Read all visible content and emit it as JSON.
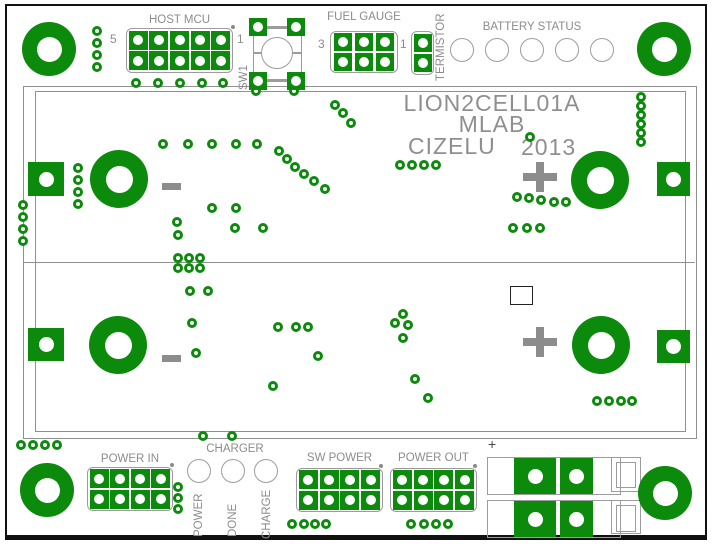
{
  "title_block": {
    "product": "LION2CELL01A",
    "org": "MLAB",
    "author": "CIZELU",
    "year": "2013"
  },
  "connectors": {
    "host_mcu": {
      "label": "HOST MCU",
      "pin_left": "5",
      "pin_right": "1"
    },
    "sw1": {
      "label": "SW1"
    },
    "fuel_gauge": {
      "label": "FUEL GAUGE",
      "pin_left": "3",
      "pin_right": "1"
    },
    "termistor": {
      "label": "TERMISTOR"
    },
    "battery_status": {
      "label": "BATTERY STATUS",
      "led_count": 5
    },
    "power_in": {
      "label": "POWER IN"
    },
    "charger": {
      "label": "CHARGER",
      "leds": [
        "POWER",
        "DONE",
        "CHARGE"
      ]
    },
    "sw_power": {
      "label": "SW POWER"
    },
    "power_out": {
      "label": "POWER OUT"
    },
    "battery_connector": {
      "polarity_label": "+"
    }
  },
  "colors": {
    "copper_green": "#0b8a0b",
    "silkscreen_gray": "#8c8c8c",
    "outline_gray": "#9c9c9c",
    "board_frame": "#111111",
    "background": "#ffffff"
  },
  "polarity_marks": {
    "plus_centers": [
      [
        540,
        177
      ],
      [
        540,
        342
      ]
    ],
    "minus_centers": [
      [
        171,
        186
      ],
      [
        171,
        358
      ]
    ]
  },
  "drill": {
    "mounting_holes": [
      [
        49,
        49
      ],
      [
        664,
        49
      ],
      [
        47,
        490
      ],
      [
        665,
        493
      ]
    ],
    "battery_rings": [
      [
        119,
        179
      ],
      [
        600,
        180
      ],
      [
        118,
        345
      ],
      [
        601,
        345
      ]
    ],
    "square_pads": [
      {
        "x": 28,
        "y": 162,
        "w": 36,
        "h": 34
      },
      {
        "x": 657,
        "y": 162,
        "w": 33,
        "h": 34
      },
      {
        "x": 28,
        "y": 328,
        "w": 36,
        "h": 33
      },
      {
        "x": 657,
        "y": 330,
        "w": 33,
        "h": 33
      },
      {
        "x": 514,
        "y": 458,
        "w": 42,
        "h": 36
      },
      {
        "x": 560,
        "y": 458,
        "w": 33,
        "h": 36
      },
      {
        "x": 514,
        "y": 501,
        "w": 42,
        "h": 36
      },
      {
        "x": 560,
        "y": 501,
        "w": 33,
        "h": 36
      }
    ],
    "vias": [
      [
        97,
        31
      ],
      [
        97,
        43
      ],
      [
        97,
        55
      ],
      [
        97,
        67
      ],
      [
        136,
        83
      ],
      [
        158,
        83
      ],
      [
        180,
        83
      ],
      [
        202,
        83
      ],
      [
        223,
        83
      ],
      [
        256,
        91
      ],
      [
        294,
        91
      ],
      [
        641,
        97
      ],
      [
        641,
        106
      ],
      [
        641,
        115
      ],
      [
        641,
        124
      ],
      [
        641,
        133
      ],
      [
        641,
        142
      ],
      [
        163,
        144
      ],
      [
        188,
        144
      ],
      [
        212,
        144
      ],
      [
        236,
        144
      ],
      [
        257,
        144
      ],
      [
        279,
        151
      ],
      [
        287,
        159
      ],
      [
        295,
        167
      ],
      [
        304,
        174
      ],
      [
        314,
        181
      ],
      [
        325,
        189
      ],
      [
        335,
        105
      ],
      [
        343,
        113
      ],
      [
        351,
        123
      ],
      [
        530,
        137
      ],
      [
        400,
        165
      ],
      [
        412,
        165
      ],
      [
        424,
        165
      ],
      [
        436,
        165
      ],
      [
        23,
        205
      ],
      [
        23,
        217
      ],
      [
        23,
        229
      ],
      [
        23,
        241
      ],
      [
        78,
        168
      ],
      [
        78,
        180
      ],
      [
        78,
        192
      ],
      [
        78,
        204
      ],
      [
        212,
        208
      ],
      [
        236,
        208
      ],
      [
        177,
        222
      ],
      [
        178,
        235
      ],
      [
        235,
        228
      ],
      [
        263,
        228
      ],
      [
        517,
        197
      ],
      [
        529,
        198
      ],
      [
        541,
        200
      ],
      [
        554,
        202
      ],
      [
        566,
        202
      ],
      [
        513,
        228
      ],
      [
        527,
        228
      ],
      [
        540,
        228
      ],
      [
        178,
        258
      ],
      [
        189,
        258
      ],
      [
        200,
        258
      ],
      [
        178,
        268
      ],
      [
        189,
        268
      ],
      [
        200,
        268
      ],
      [
        190,
        291
      ],
      [
        208,
        291
      ],
      [
        192,
        323
      ],
      [
        196,
        353
      ],
      [
        278,
        327
      ],
      [
        296,
        327
      ],
      [
        308,
        327
      ],
      [
        318,
        356
      ],
      [
        273,
        386
      ],
      [
        403,
        314
      ],
      [
        395,
        323
      ],
      [
        408,
        325
      ],
      [
        403,
        338
      ],
      [
        415,
        379
      ],
      [
        428,
        398
      ],
      [
        597,
        401
      ],
      [
        609,
        401
      ],
      [
        621,
        401
      ],
      [
        632,
        401
      ],
      [
        21,
        445
      ],
      [
        33,
        445
      ],
      [
        45,
        445
      ],
      [
        57,
        445
      ],
      [
        203,
        436
      ],
      [
        232,
        436
      ],
      [
        178,
        487
      ],
      [
        178,
        498
      ],
      [
        178,
        509
      ],
      [
        292,
        524
      ],
      [
        304,
        524
      ],
      [
        315,
        524
      ],
      [
        326,
        524
      ],
      [
        411,
        524
      ],
      [
        424,
        524
      ],
      [
        436,
        524
      ],
      [
        448,
        524
      ]
    ]
  }
}
